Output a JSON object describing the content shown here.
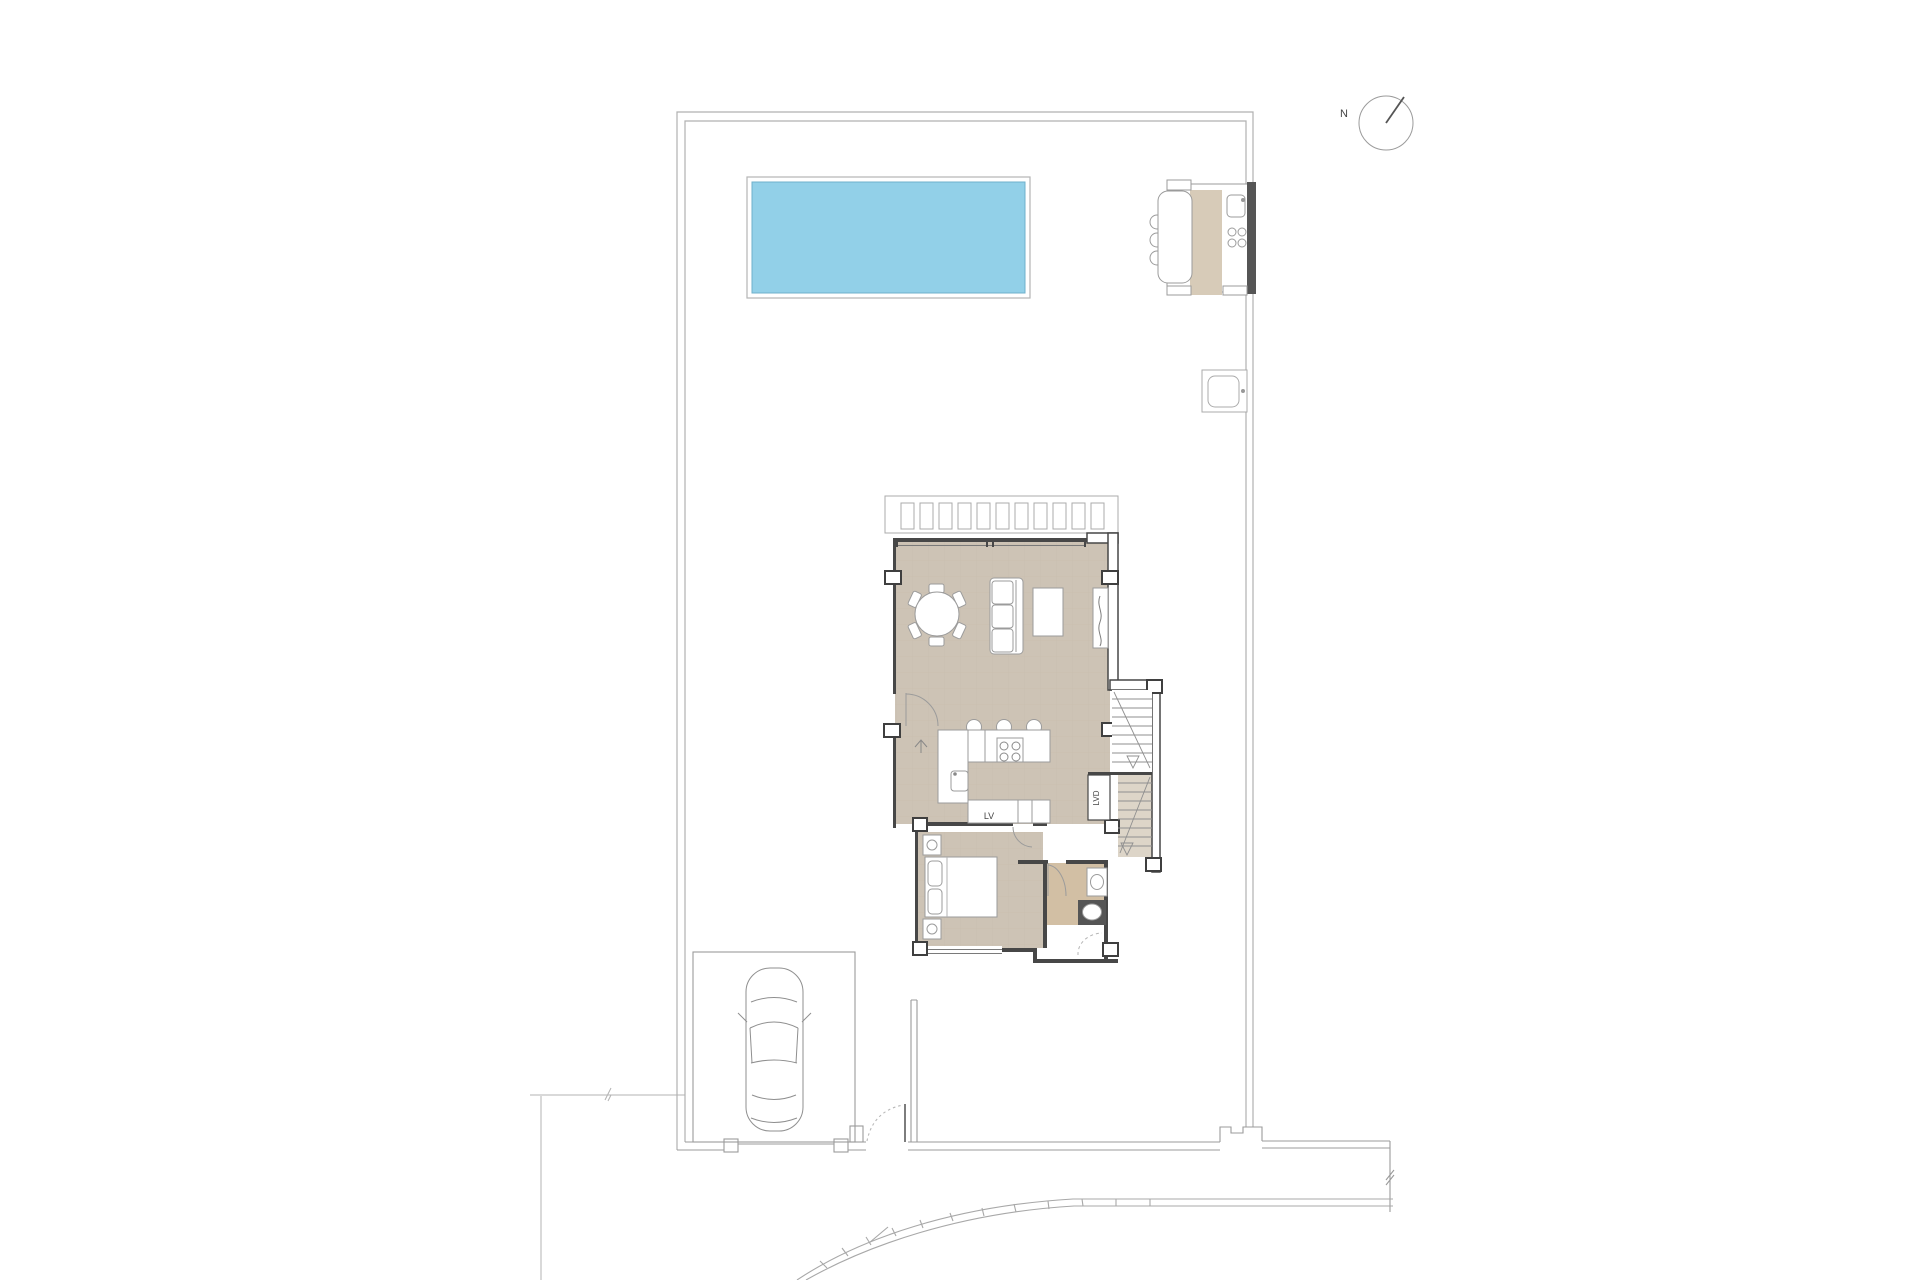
{
  "plan": {
    "labels": {
      "dishwasher": "LV",
      "laundry": "LVD",
      "north": "N"
    },
    "colors": {
      "pool_water": "#92d0e8",
      "pool_edge": "#6fb0cb",
      "floor_main": "#cdc3b5",
      "floor_grid": "#c0b5a5",
      "floor_bath": "#d2bfa4",
      "outdoor_counter": "#d7cbb8",
      "stair_fill": "#ddd5c8",
      "wall_dark": "#474747",
      "line_grey": "#9b9b9b",
      "line_light": "#b0b0b0"
    }
  }
}
